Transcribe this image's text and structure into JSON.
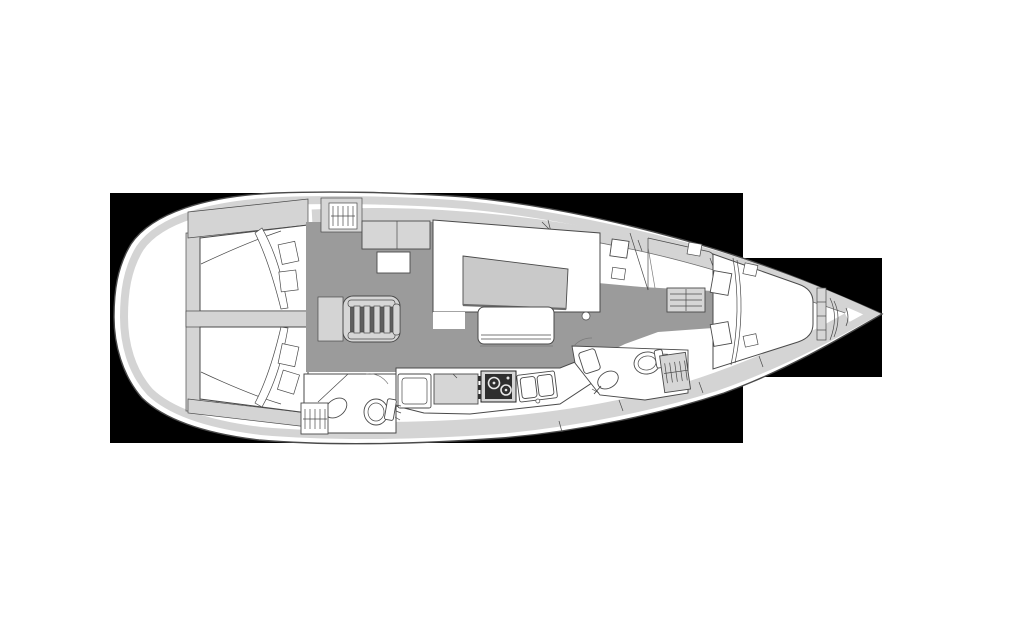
{
  "diagram": {
    "type": "sailing-yacht-interior-floor-plan",
    "orientation": "bow-right",
    "canvas": {
      "width": 1024,
      "height": 644
    },
    "colors": {
      "mask": "#000000",
      "hull": "#ffffff",
      "deck_band": "#d4d4d4",
      "furniture_light": "#d6d6d6",
      "floor": "#9b9b9b",
      "table": "#c9c9c9",
      "stove": "#2f2f2f",
      "outline": "#4a4a4a"
    },
    "mask_rects": [
      {
        "name": "main",
        "x": 110,
        "y": 193,
        "w": 633,
        "h": 250
      },
      {
        "name": "bow",
        "x": 743,
        "y": 258,
        "w": 139,
        "h": 119
      }
    ],
    "areas": [
      "stern-transom",
      "aft-cabin-port",
      "aft-cabin-starboard",
      "companionway-steps",
      "wardrobe-port",
      "salon-settee",
      "salon-table",
      "salon-bench",
      "galley",
      "galley-stove",
      "galley-sink",
      "galley-fridge",
      "aft-head-toilet",
      "aft-head-sink",
      "nav-seat-area",
      "drawer-unit",
      "fwd-head-toilet",
      "fwd-head-sink",
      "fwd-head-wardrobe",
      "fwd-cabin-berth",
      "bow-locker"
    ]
  }
}
